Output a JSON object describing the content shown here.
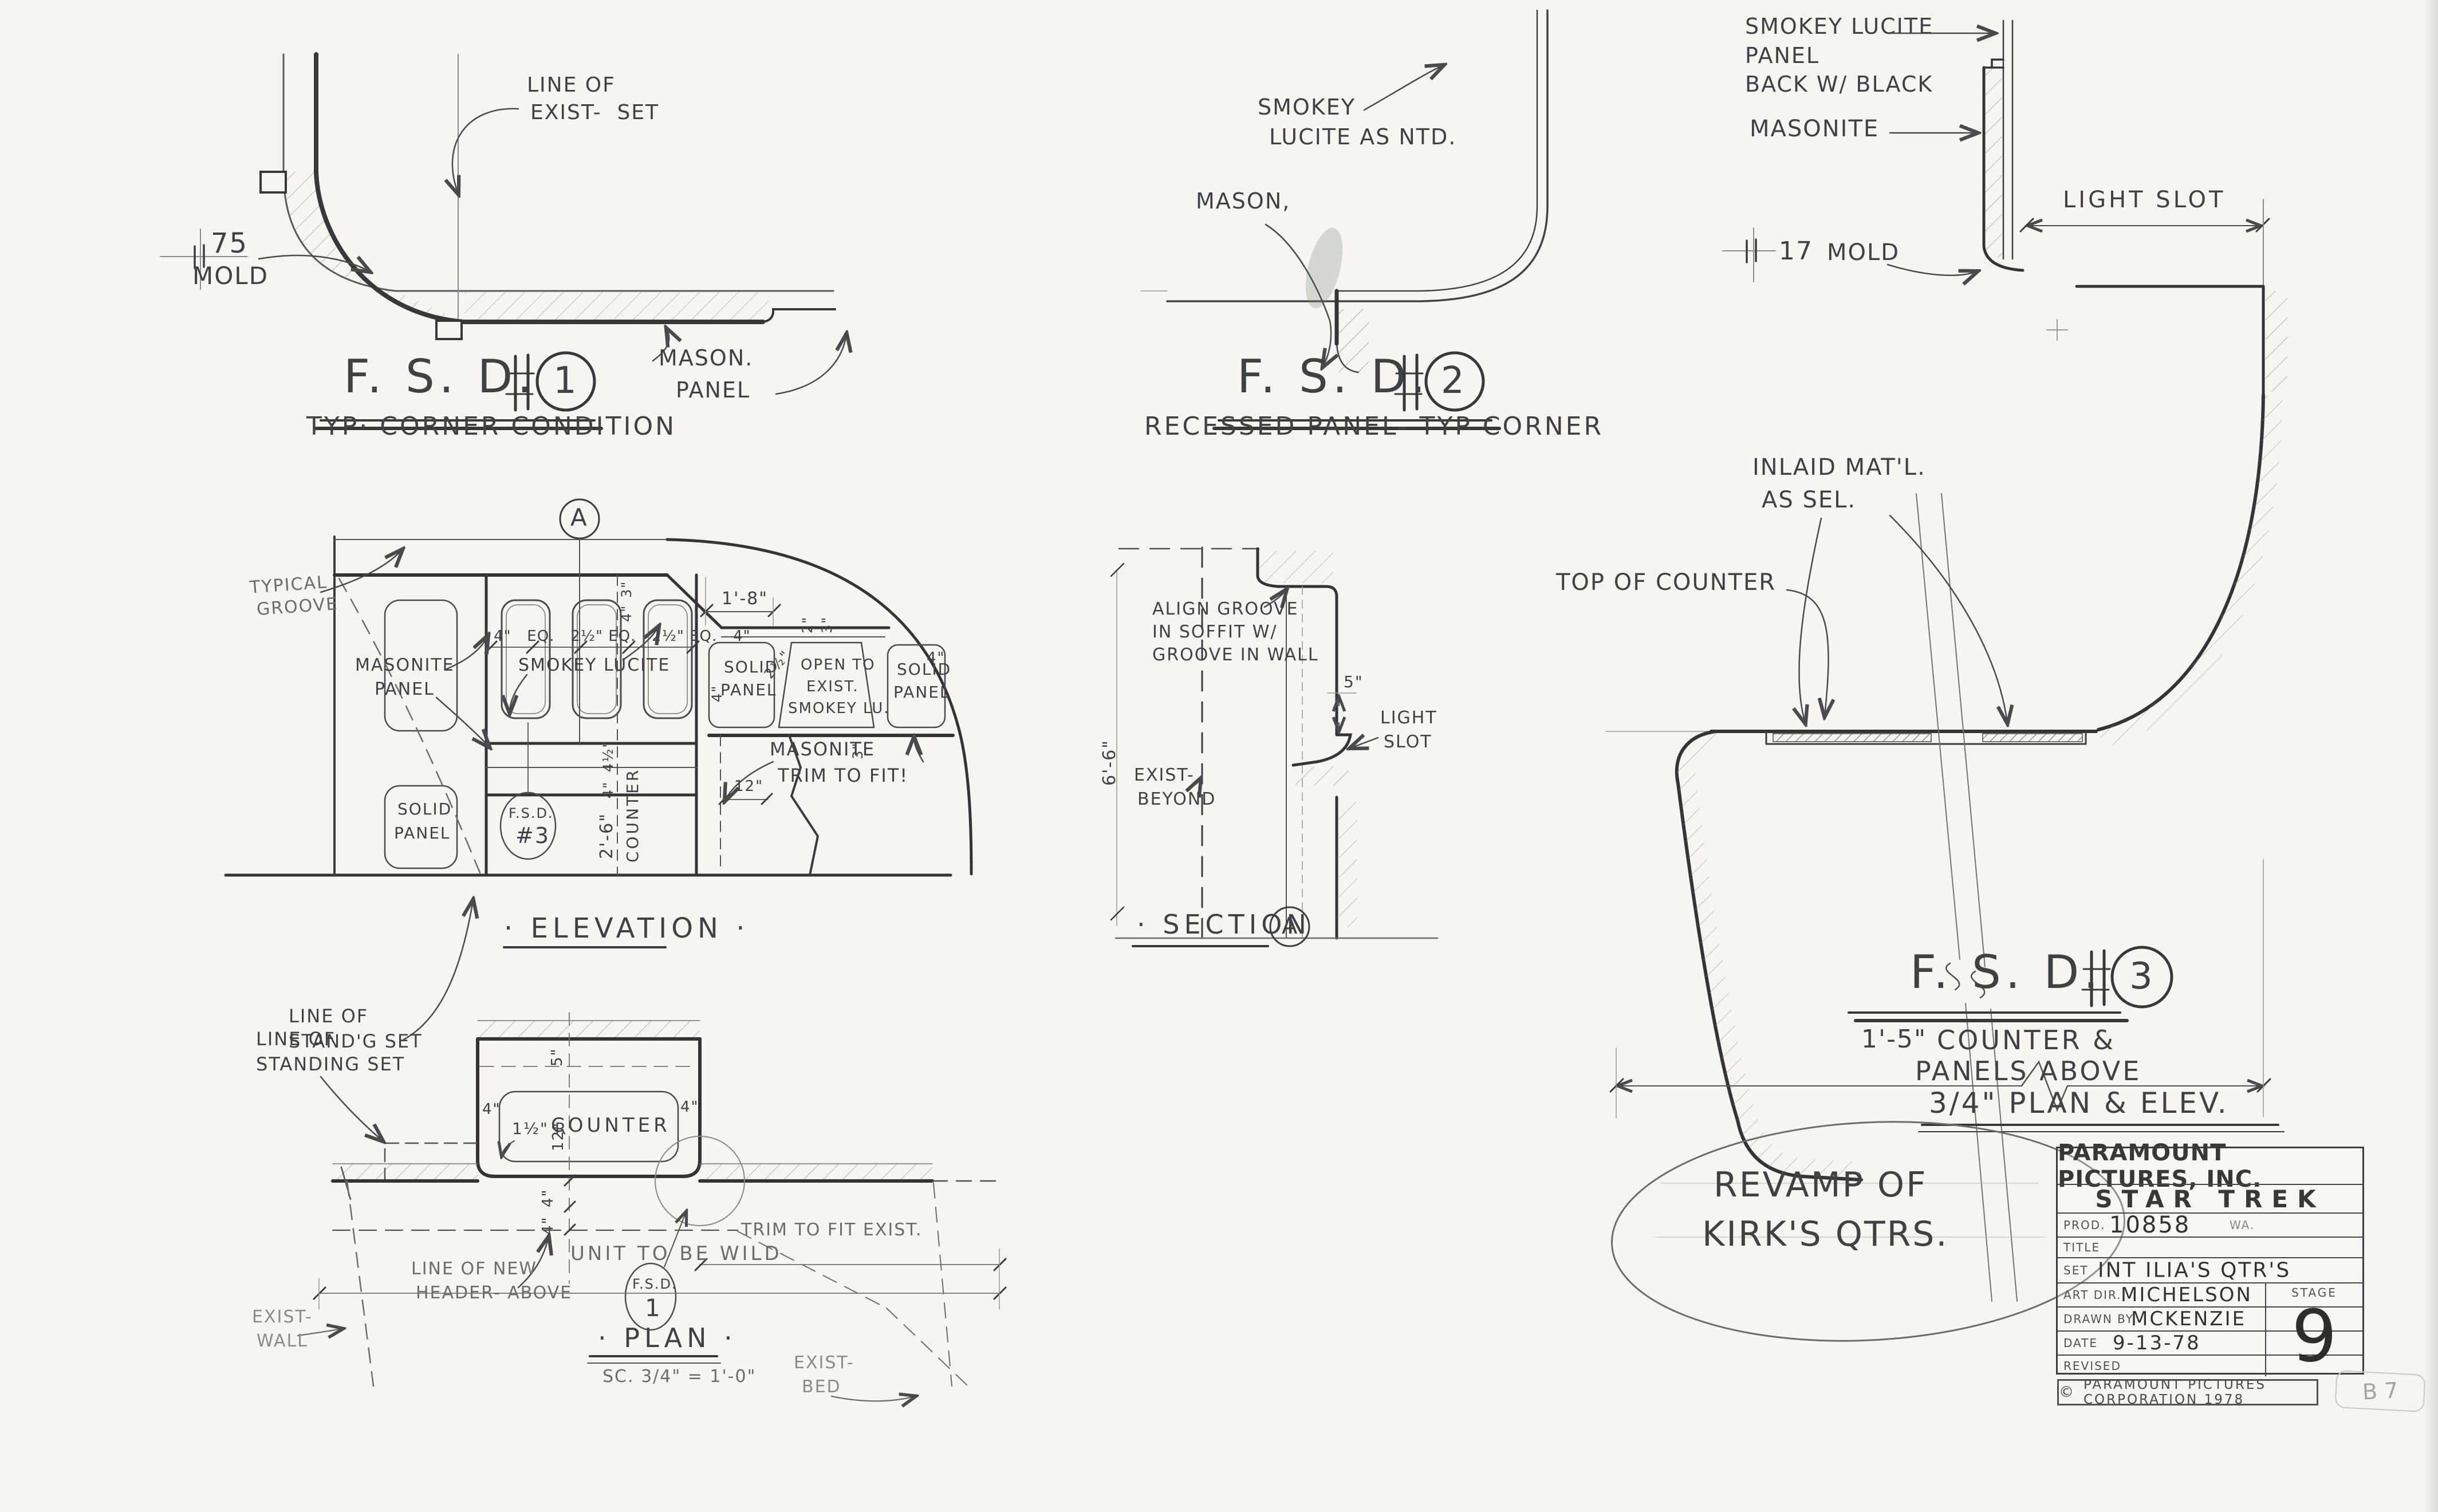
{
  "fsd1": {
    "label_exist_1": "LINE OF",
    "label_exist_2": "EXIST-  SET",
    "mold_num": "75",
    "mold": "MOLD",
    "label_mason": "MASON.",
    "label_panel": "PANEL",
    "title": "F. S. D.",
    "number": "1",
    "subtitle": "TYP· CORNER CONDITION"
  },
  "fsd2": {
    "label_smokey_1": "SMOKEY",
    "label_smokey_2": "LUCITE AS NTD.",
    "label_mason": "MASON,",
    "title": "F. S. D.",
    "number": "2",
    "subtitle": "RECESSED PANEL- TYP CORNER"
  },
  "fsd3": {
    "label_smokey_1": "SMOKEY LUCITE",
    "label_smokey_2": "PANEL",
    "label_smokey_3": "BACK W/ BLACK",
    "label_masonite": "MASONITE",
    "mold_num": "17",
    "mold": "MOLD",
    "label_light_slot": "LIGHT SLOT",
    "label_inlaid_1": "INLAID MAT'L.",
    "label_inlaid_2": "AS SEL.",
    "label_top_of_counter": "TOP OF COUNTER",
    "dim_width": "1'-5\"",
    "title": "F. S. D.",
    "number": "3",
    "subtitle_1": "COUNTER &",
    "subtitle_2": "PANELS ABOVE",
    "scale_note": "3/4\" PLAN & ELEV."
  },
  "elevation": {
    "bubble": "A",
    "label_typical_1": "TYPICAL",
    "label_typical_2": "GROOVE",
    "label_masonite_1": "MASONITE",
    "label_masonite_2": "PANEL",
    "label_smokey": "SMOKEY LUCITE",
    "dim_1_8": "1'-8\"",
    "dims_row": "4\"   EQ.   2½\" EQ.   2½\" EQ.   4\"",
    "dim_3_top": "3\"",
    "dim_4_top": "4\"",
    "dim_2_r": "2\"",
    "dim_3_r": "3\"",
    "dim_2half_r": "2½\"",
    "dim_4_row_l": "4\"",
    "dim_4_row_r": "4\"",
    "dim_3_below": "3\"",
    "dim_12": "12\"",
    "dim_4half": "4½\"",
    "dim_4_mid": "4\"",
    "solid_a1": "SOLID",
    "solid_a2": "PANEL",
    "open_1": "OPEN TO",
    "open_2": "EXIST.",
    "open_3": "SMOKEY LU.",
    "solid_b1": "SOLID",
    "solid_b2": "PANEL",
    "solid_c1": "SOLID",
    "solid_c2": "PANEL",
    "label_trim_1": "MASONITE",
    "label_trim_2": "TRIM TO FIT!",
    "counter_dim": "2'-6\"",
    "counter_word": "COUNTER",
    "fsd_ref": "F.S.D.",
    "fsd_ref_num": "#3",
    "label_standg_1": "LINE OF",
    "label_standg_2": "STAND'G SET",
    "title": "· ELEVATION ·"
  },
  "sectionA": {
    "label_align_1": "ALIGN GROOVE",
    "label_align_2": "IN SOFFIT W/",
    "label_align_3": "GROOVE IN WALL",
    "label_exist_1": "EXIST-",
    "label_exist_2": "BEYOND",
    "label_light_1": "LIGHT",
    "label_light_2": "SLOT",
    "dim_5": "5\"",
    "dim_height": "6'-6\"",
    "title": "· SECTION",
    "bubble": "A"
  },
  "plan": {
    "label_standing_1": "LINE OF",
    "label_standing_2": "STANDING SET",
    "counter": "COUNTER",
    "radius": "1½\" R",
    "dim_4_left": "4\"",
    "dim_4_right": "4\"",
    "dim_5": "5\"",
    "dim_12": "12\"",
    "dim_4_a": "4\"",
    "dim_4_b": "4\"",
    "label_header_1": "LINE OF NEW",
    "label_header_2": "HEADER- ABOVE",
    "label_exist_wall_1": "EXIST-",
    "label_exist_wall_2": "WALL",
    "fsd_ref": "F.S.D.",
    "fsd_ref_num": "1",
    "label_exist_bed_1": "EXIST-",
    "label_exist_bed_2": "BED",
    "label_trim": "TRIM TO FIT EXIST.",
    "label_unit": "UNIT TO BE WILD",
    "title": "· PLAN ·",
    "scale": "SC. 3/4\" = 1'-0\""
  },
  "revamp": {
    "line1": "REVAMP OF",
    "line2": "KIRK'S QTRS."
  },
  "title_block": {
    "company": "PARAMOUNT PICTURES, INC.",
    "production": "STAR TREK",
    "prod_label": "PROD.",
    "prod_value": "10858",
    "prod_suffix": "WA.",
    "title_label": "TITLE",
    "title_value": "",
    "set_label": "SET",
    "set_value": "INT ILIA'S QTR'S",
    "art_dir_label": "ART DIR.",
    "art_dir_value": "MICHELSON",
    "drawn_label": "DRAWN BY",
    "drawn_value": "MCKENZIE",
    "date_label": "DATE",
    "date_value": "9-13-78",
    "revised_label": "REVISED",
    "revised_value": "",
    "stage_label": "STAGE",
    "stage_value": "9",
    "copyright_symbol": "©",
    "copyright": "PARAMOUNT PICTURES CORPORATION 1978",
    "pencil_note": "B 7"
  }
}
